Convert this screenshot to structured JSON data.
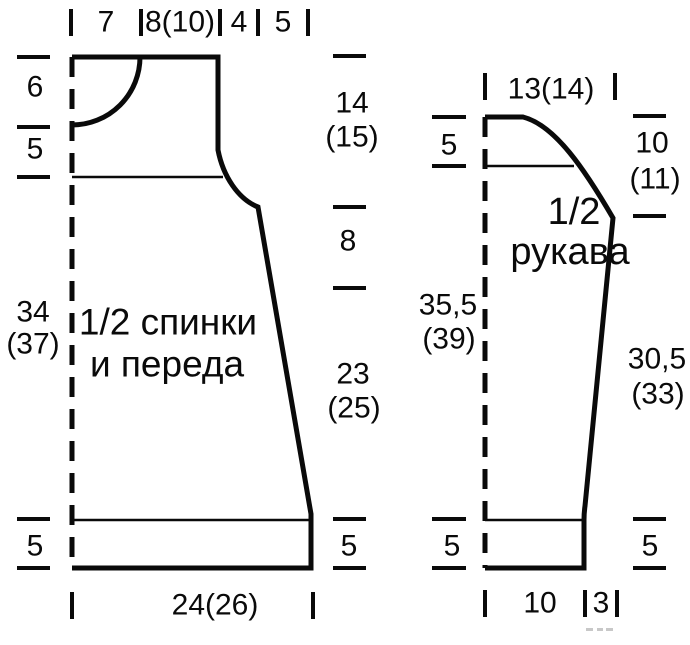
{
  "figure": {
    "kind": "knitting pattern schematic",
    "language": "ru",
    "background_color": "#ffffff",
    "line_color": "#0a0a0a"
  },
  "body_piece": {
    "title_line1": "1/2 спинки",
    "title_line2": "и переда",
    "top_widths": [
      "7",
      "8(10)",
      "4",
      "5"
    ],
    "left_heights": [
      "6",
      "5",
      "34",
      "(37)",
      "5"
    ],
    "right_heights": [
      "14",
      "(15)",
      "8",
      "23",
      "(25)",
      "5"
    ],
    "bottom_width": "24(26)"
  },
  "sleeve_piece": {
    "title_line1": "1/2",
    "title_line2": "рукава",
    "top_width": "13(14)",
    "left_heights": [
      "5",
      "35,5",
      "(39)",
      "5"
    ],
    "right_heights": [
      "10",
      "(11)",
      "30,5",
      "(33)",
      "5"
    ],
    "bottom_widths": [
      "10",
      "3"
    ]
  }
}
